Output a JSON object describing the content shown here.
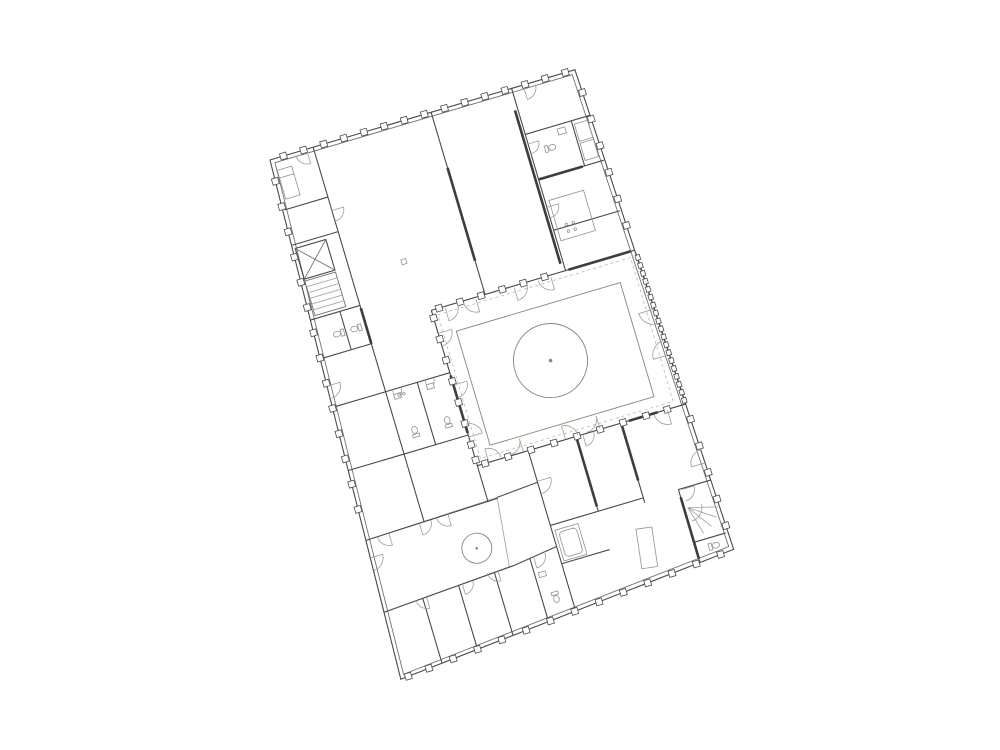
{
  "document": {
    "type": "architectural-floor-plan",
    "background": "#ffffff"
  },
  "palette": {
    "lawn_green": "#a9c28e",
    "courtyard_paving_green": "#e6ecdc",
    "terrace_green": "#e9efe2",
    "wall_line": "#4a4a4a",
    "heavy_wall_line": "#3d3d3d",
    "partition_line": "#6f746c",
    "light_line": "#9aa096",
    "fixture_line": "#8f948c",
    "tree_line": "#7c8d70",
    "dashed_line": "#b3bda6",
    "window_fill": "#ffffff"
  }
}
